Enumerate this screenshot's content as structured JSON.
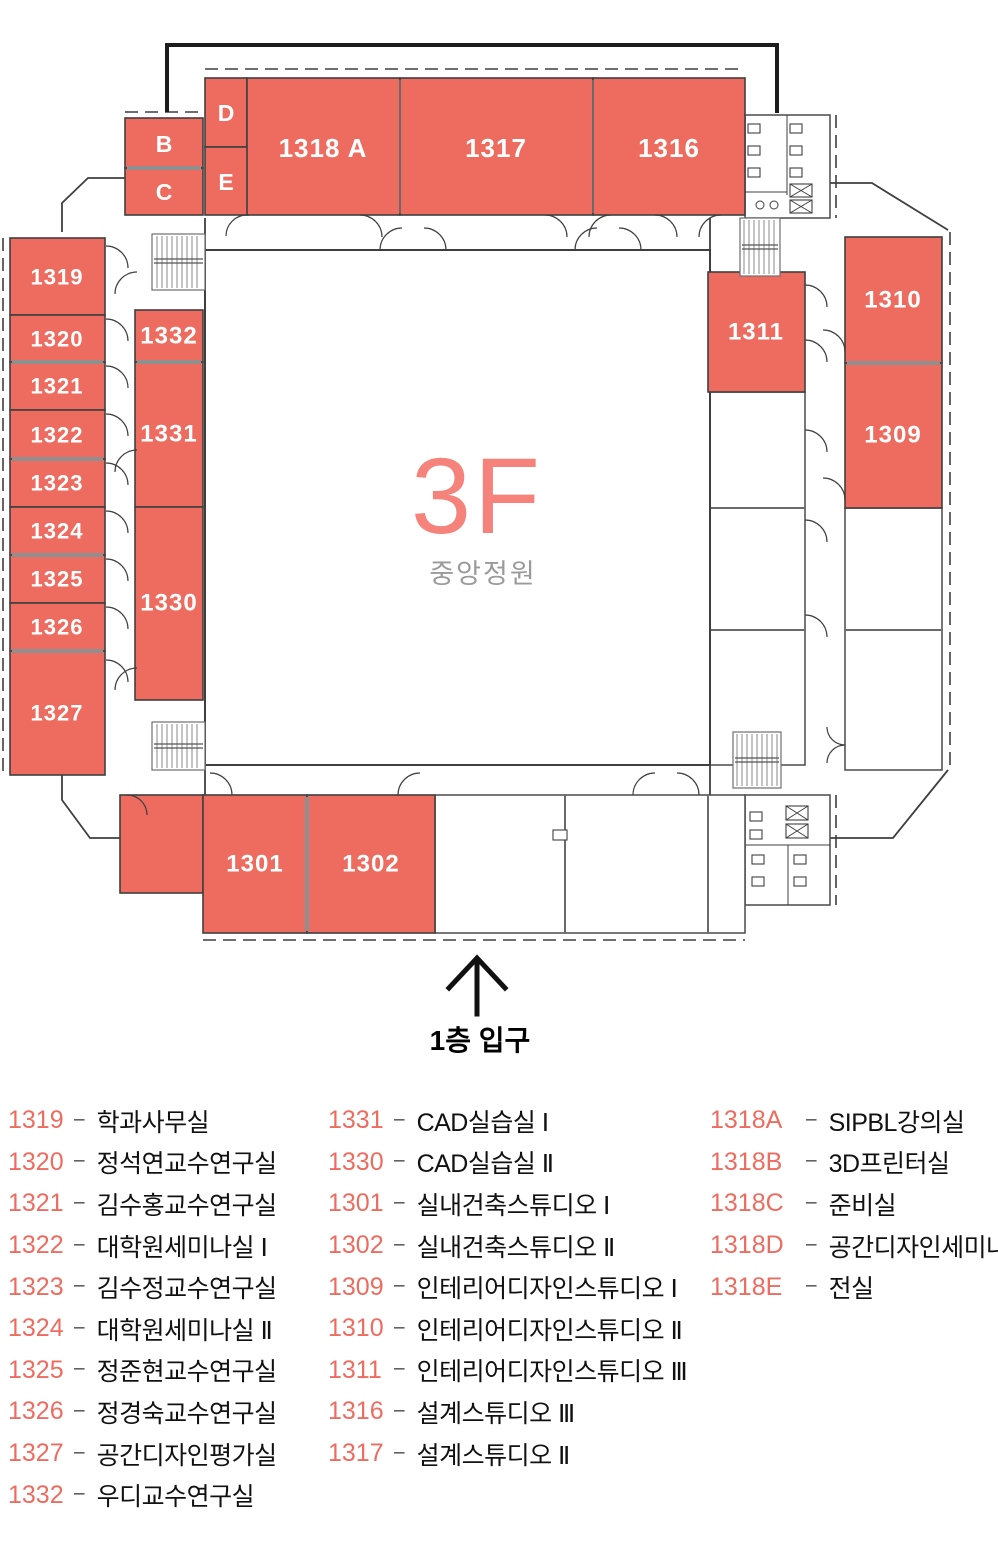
{
  "floor": {
    "title": "3F",
    "courtyard": "중앙정원",
    "entrance": "1층 입구"
  },
  "plan": {
    "labels": {
      "b": "B",
      "c": "C",
      "d": "D",
      "e": "E",
      "a1318": "1318 A",
      "r1317": "1317",
      "r1316": "1316",
      "r1319": "1319",
      "r1320": "1320",
      "r1321": "1321",
      "r1322": "1322",
      "r1323": "1323",
      "r1324": "1324",
      "r1325": "1325",
      "r1326": "1326",
      "r1327": "1327",
      "r1332": "1332",
      "r1331": "1331",
      "r1330": "1330",
      "r1311": "1311",
      "r1310": "1310",
      "r1309": "1309",
      "r1301": "1301",
      "r1302": "1302"
    }
  },
  "legend": {
    "dash": "–",
    "columns": [
      [
        {
          "num": "1319",
          "name": "학과사무실"
        },
        {
          "num": "1320",
          "name": "정석연교수연구실"
        },
        {
          "num": "1321",
          "name": "김수홍교수연구실"
        },
        {
          "num": "1322",
          "name": "대학원세미나실 Ⅰ"
        },
        {
          "num": "1323",
          "name": "김수정교수연구실"
        },
        {
          "num": "1324",
          "name": "대학원세미나실 Ⅱ"
        },
        {
          "num": "1325",
          "name": "정준현교수연구실"
        },
        {
          "num": "1326",
          "name": "정경숙교수연구실"
        },
        {
          "num": "1327",
          "name": "공간디자인평가실"
        },
        {
          "num": "1332",
          "name": "우디교수연구실"
        }
      ],
      [
        {
          "num": "1331",
          "name": "CAD실습실 Ⅰ"
        },
        {
          "num": "1330",
          "name": "CAD실습실 Ⅱ"
        },
        {
          "num": "1301",
          "name": "실내건축스튜디오 Ⅰ"
        },
        {
          "num": "1302",
          "name": "실내건축스튜디오 Ⅱ"
        },
        {
          "num": "1309",
          "name": "인테리어디자인스튜디오 Ⅰ"
        },
        {
          "num": "1310",
          "name": "인테리어디자인스튜디오 Ⅱ"
        },
        {
          "num": "1311",
          "name": "인테리어디자인스튜디오 Ⅲ"
        },
        {
          "num": "1316",
          "name": "설계스튜디오 Ⅲ"
        },
        {
          "num": "1317",
          "name": "설계스튜디오 Ⅱ"
        }
      ],
      [
        {
          "num": "1318A",
          "name": "SIPBL강의실"
        },
        {
          "num": "1318B",
          "name": "3D프린터실"
        },
        {
          "num": "1318C",
          "name": "준비실"
        },
        {
          "num": "1318D",
          "name": "공간디자인세미나실"
        },
        {
          "num": "1318E",
          "name": "전실"
        }
      ]
    ]
  },
  "colors": {
    "room_fill": "#ee6c5f",
    "floor_title": "#f5837b",
    "courtyard_text": "#9a9a9a",
    "wall": "#3f3f3f",
    "legend_number": "#ee6c5f",
    "legend_text": "#111111"
  }
}
